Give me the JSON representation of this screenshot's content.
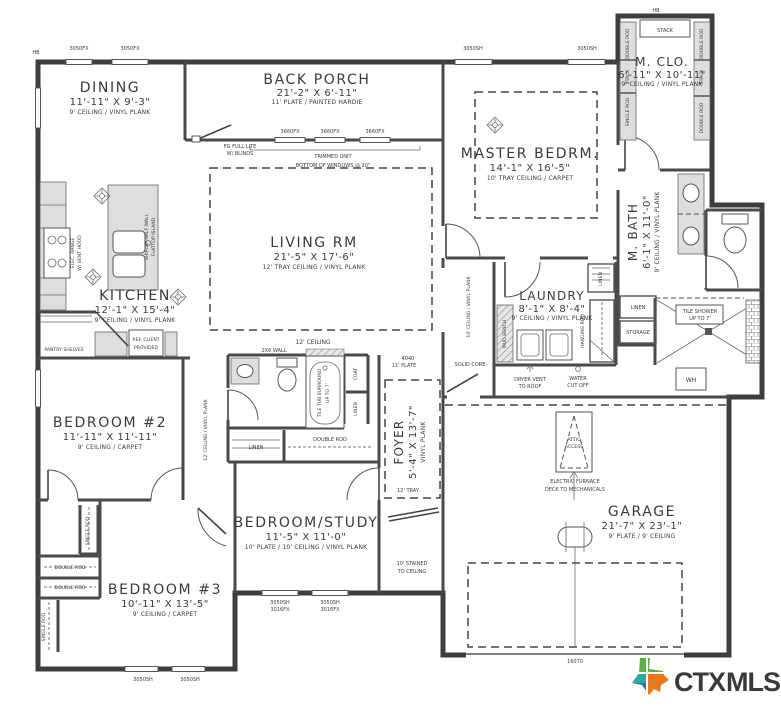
{
  "page": {
    "background": "#ffffff"
  },
  "rooms": {
    "dining": {
      "name": "DINING",
      "dims": "11'-11\" X 9'-3\"",
      "note": "9' CEILING / VINYL PLANK"
    },
    "back_porch": {
      "name": "BACK PORCH",
      "dims": "21'-2\" X 6'-11\"",
      "note": "11' PLATE / PAINTED HARDIE"
    },
    "master_bedroom": {
      "name": "MASTER BEDRM.",
      "dims": "14'-1\" X 16'-5\"",
      "note": "10' TRAY CEILING / CARPET"
    },
    "master_closet": {
      "name": "M. CLO.",
      "dims": "6'-11\" X 10'-11\"",
      "note": "9' CEILING / VINYL PLANK"
    },
    "kitchen": {
      "name": "KITCHEN",
      "dims": "12'-1\" X 15'-4\"",
      "note": "9' CEILING / VINYL PLANK"
    },
    "living": {
      "name": "LIVING RM",
      "dims": "21'-5\" X 17'-6\"",
      "note": "12' TRAY CEILING / VINYL PLANK"
    },
    "laundry": {
      "name": "LAUNDRY",
      "dims": "8'-1\" X 8'-4\"",
      "note": "9' CEILING / VINYL PLANK"
    },
    "master_bath": {
      "name": "M. BATH",
      "dims": "6'-1\" X 11'-0\"",
      "note": "9' CEILING / VINYL PLANK"
    },
    "bedroom2": {
      "name": "BEDROOM #2",
      "dims": "11'-11\" X 11'-11\"",
      "note": "9' CEILING / CARPET"
    },
    "foyer": {
      "name": "FOYER",
      "dims": "5'-4\" X 13'-7\"",
      "note": "VINYL PLANK"
    },
    "bedroom_study": {
      "name": "BEDROOM/STUDY",
      "dims": "11'-5\" X 11'-0\"",
      "note": "10' PLATE / 10' CEILING / VINYL PLANK"
    },
    "bedroom3": {
      "name": "BEDROOM #3",
      "dims": "10'-11\" X 13'-5\"",
      "note": "9' CEILING / CARPET"
    },
    "garage": {
      "name": "GARAGE",
      "dims": "21'-7\" X 23'-1\"",
      "note": "9' PLATE / 9' CEILING"
    }
  },
  "annotations": {
    "windows": {
      "fx3050": "3050FX",
      "fx3660": "3660FX",
      "sh3050": "3050SH",
      "fx3016": "3016FX",
      "n4040": "4040",
      "garage_door": "16070"
    },
    "fg_door": [
      "FG FULL LITE",
      "W/ BLINDS"
    ],
    "trimmed_unit": "TRIMMED UNIT",
    "bottom_of_windows": "BOTTOM OF WINDOWS @ 20\"",
    "ceiling_12": "12' CEILING",
    "wall_2x6": "2X6 WALL",
    "mud_bench": "MUD BENCH",
    "dryer_vent": [
      "DRYER VENT",
      "TO ROOF"
    ],
    "water_cut_off": [
      "WATER",
      "CUT OFF"
    ],
    "solid_core": "SOLID CORE",
    "linen": "LINEN",
    "storage": "STORAGE",
    "coat": "COAT",
    "hanging_rod": "HANGING ROD",
    "double_rod": "DOUBLE ROD",
    "single_rod": "SINGLE ROD",
    "stack": "STACK",
    "tile_shower": [
      "TILE SHOWER",
      "UP TO 7'"
    ],
    "tile_tub": [
      "TILE TUB SURROUND",
      "UP TO 7'"
    ],
    "elec_range": [
      "ELEC. RANGE",
      "W/ VENT HOOD"
    ],
    "refrigerator": [
      "REF. CLIENT",
      "PROVIDED"
    ],
    "island": [
      "SHIPLAP HALF WALL",
      "FLATTOP ISLAND"
    ],
    "attic_access": [
      "ATTIC",
      "ACCESS"
    ],
    "electric_furnace": [
      "ELECTRIC FURNACE",
      "DECK TO MECHANICALS"
    ],
    "stained_ceiling": [
      "10' STAINED",
      "TO CEILING"
    ],
    "pantry_shelves": "PANTRY SHELVES",
    "hall_ceiling_12": "12' CEILING / VINYL PLANK",
    "hall_ceiling_10": "10' CEILING / VINYL PLANK",
    "plate_11": "11' PLATE",
    "tray_12": "12' TRAY",
    "hose_bib": "HB",
    "water_heater": "WH"
  },
  "logo": {
    "ctx": "CTX",
    "mls": "MLS",
    "ctx_color": "#E8771E",
    "mls_color": "#1C6FB8",
    "texas_green": "#5FB043",
    "texas_teal": "#2FA8A0",
    "texas_blue": "#2D6FB7",
    "texas_orange": "#E8771E"
  }
}
